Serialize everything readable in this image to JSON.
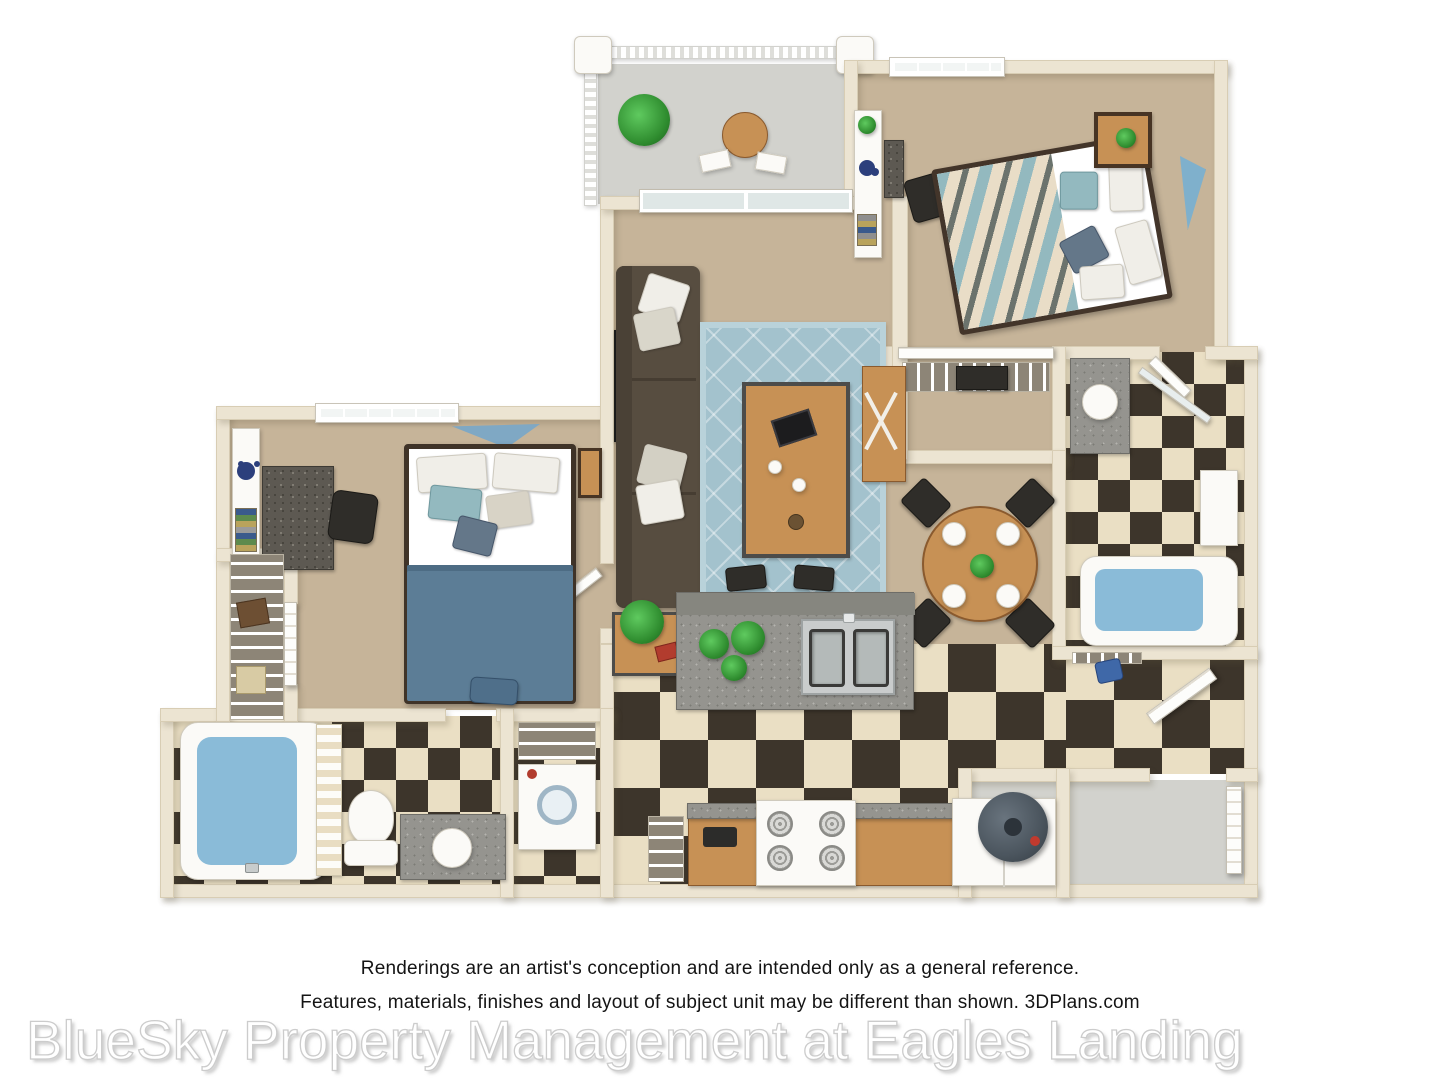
{
  "caption": {
    "line1": "Renderings are an artist's conception and are intended only as a general reference.",
    "line2": "Features, materials, finishes and layout of subject unit may be different than shown. 3DPlans.com"
  },
  "watermark": "BlueSky Property Management at Eagles Landing",
  "palette": {
    "wall": "#ece4d2",
    "wallEdge": "#d8cdb4",
    "carpet": "#c6b499",
    "tileDark": "#3d352b",
    "tileLight": "#eadfc4",
    "concrete": "#d2d2cd",
    "wood": "#c79155",
    "granite": "#95948f",
    "sofa": "#574d40",
    "rug": "#a3c2cd",
    "teal": "#93b9bf",
    "blanket": "#5c7d96",
    "water": "#8abbd8",
    "fixture": "#fbfaf7",
    "green": "#2e8b2e",
    "heater": "#4b555e"
  }
}
